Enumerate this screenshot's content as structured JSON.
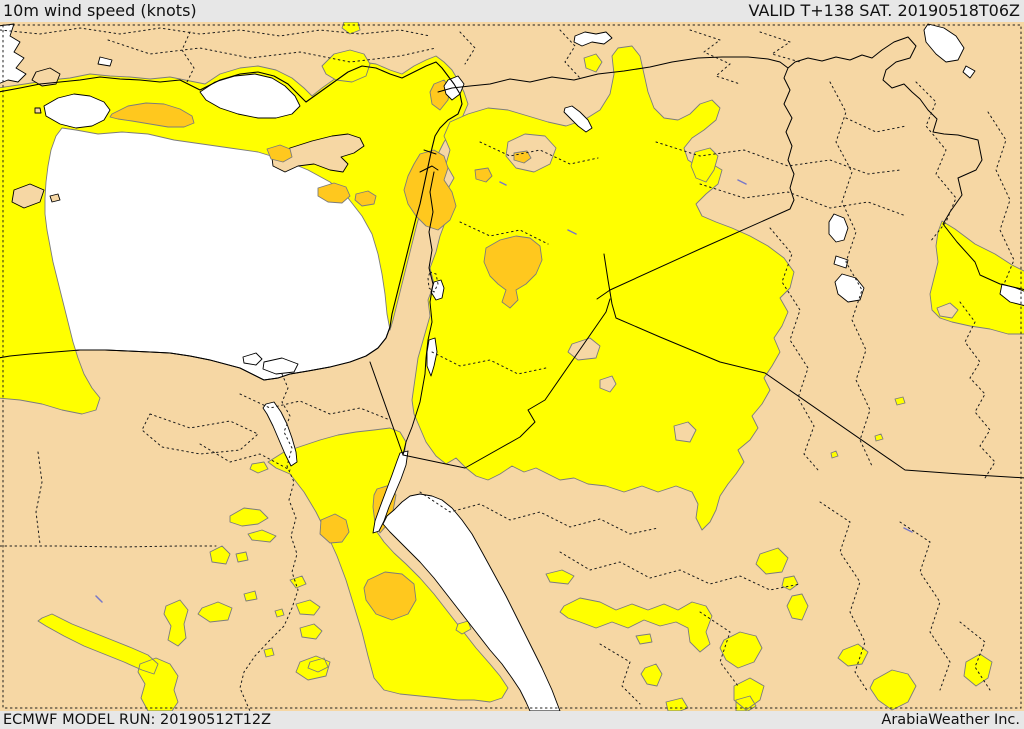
{
  "header": {
    "title": "10m wind speed (knots)",
    "valid_label": "VALID T+138 SAT. 20190518T06Z",
    "lead_time": "T+138",
    "valid_time": "20190518T06Z"
  },
  "footer": {
    "model_run_label": "ECMWF MODEL RUN: 20190512T12Z",
    "model": "ECMWF",
    "run_time": "20190512T12Z",
    "brand": "ArabiaWeather Inc."
  },
  "map": {
    "units": "knots",
    "variable": "10m wind speed"
  },
  "colors": {
    "bar_bg": "#e7e7e7",
    "text": "#111111",
    "land": "#f6d7a4",
    "sea": "#ffffff",
    "wind_band_1": "#ffff00",
    "wind_band_2": "#ffc81e",
    "contour": "#7c7c7c",
    "coast": "#000000"
  }
}
